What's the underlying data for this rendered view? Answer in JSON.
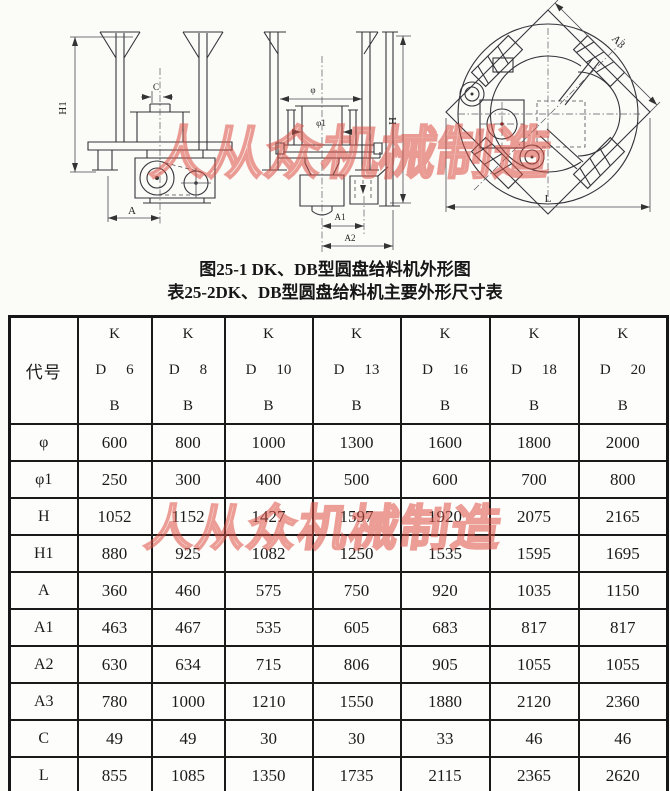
{
  "captions": {
    "figure": "图25-1 DK、DB型圆盘给料机外形图",
    "table": "表25-2DK、DB型圆盘给料机主要外形尺寸表"
  },
  "watermark": {
    "text": "人从众机械制造",
    "color": "#dd5044"
  },
  "drawings": {
    "front_view": {
      "h1": "H1",
      "c": "C",
      "a": "A"
    },
    "side_view": {
      "phi": "φ",
      "phi1": "φ1",
      "h": "H",
      "a1": "A1",
      "a2": "A2"
    },
    "top_view": {
      "a3": "A3",
      "l": "L"
    }
  },
  "table": {
    "code_header": "代号",
    "columns": [
      {
        "k": "K",
        "d": "D",
        "size": "6",
        "b": "B"
      },
      {
        "k": "K",
        "d": "D",
        "size": "8",
        "b": "B"
      },
      {
        "k": "K",
        "d": "D",
        "size": "10",
        "b": "B"
      },
      {
        "k": "K",
        "d": "D",
        "size": "13",
        "b": "B"
      },
      {
        "k": "K",
        "d": "D",
        "size": "16",
        "b": "B"
      },
      {
        "k": "K",
        "d": "D",
        "size": "18",
        "b": "B"
      },
      {
        "k": "K",
        "d": "D",
        "size": "20",
        "b": "B"
      }
    ],
    "rows": [
      {
        "label": "φ",
        "values": [
          600,
          800,
          1000,
          1300,
          1600,
          1800,
          2000
        ]
      },
      {
        "label": "φ1",
        "values": [
          250,
          300,
          400,
          500,
          600,
          700,
          800
        ]
      },
      {
        "label": "H",
        "values": [
          1052,
          1152,
          1427,
          1597,
          1920,
          2075,
          2165
        ]
      },
      {
        "label": "H1",
        "values": [
          880,
          925,
          1082,
          1250,
          1535,
          1595,
          1695
        ]
      },
      {
        "label": "A",
        "values": [
          360,
          460,
          575,
          750,
          920,
          1035,
          1150
        ]
      },
      {
        "label": "A1",
        "values": [
          463,
          467,
          535,
          605,
          683,
          817,
          817
        ]
      },
      {
        "label": "A2",
        "values": [
          630,
          634,
          715,
          806,
          905,
          1055,
          1055
        ]
      },
      {
        "label": "A3",
        "values": [
          780,
          1000,
          1210,
          1550,
          1880,
          2120,
          2360
        ]
      },
      {
        "label": "C",
        "values": [
          49,
          49,
          30,
          30,
          33,
          46,
          46
        ]
      },
      {
        "label": "L",
        "values": [
          855,
          1085,
          1350,
          1735,
          2115,
          2365,
          2620
        ]
      }
    ]
  }
}
